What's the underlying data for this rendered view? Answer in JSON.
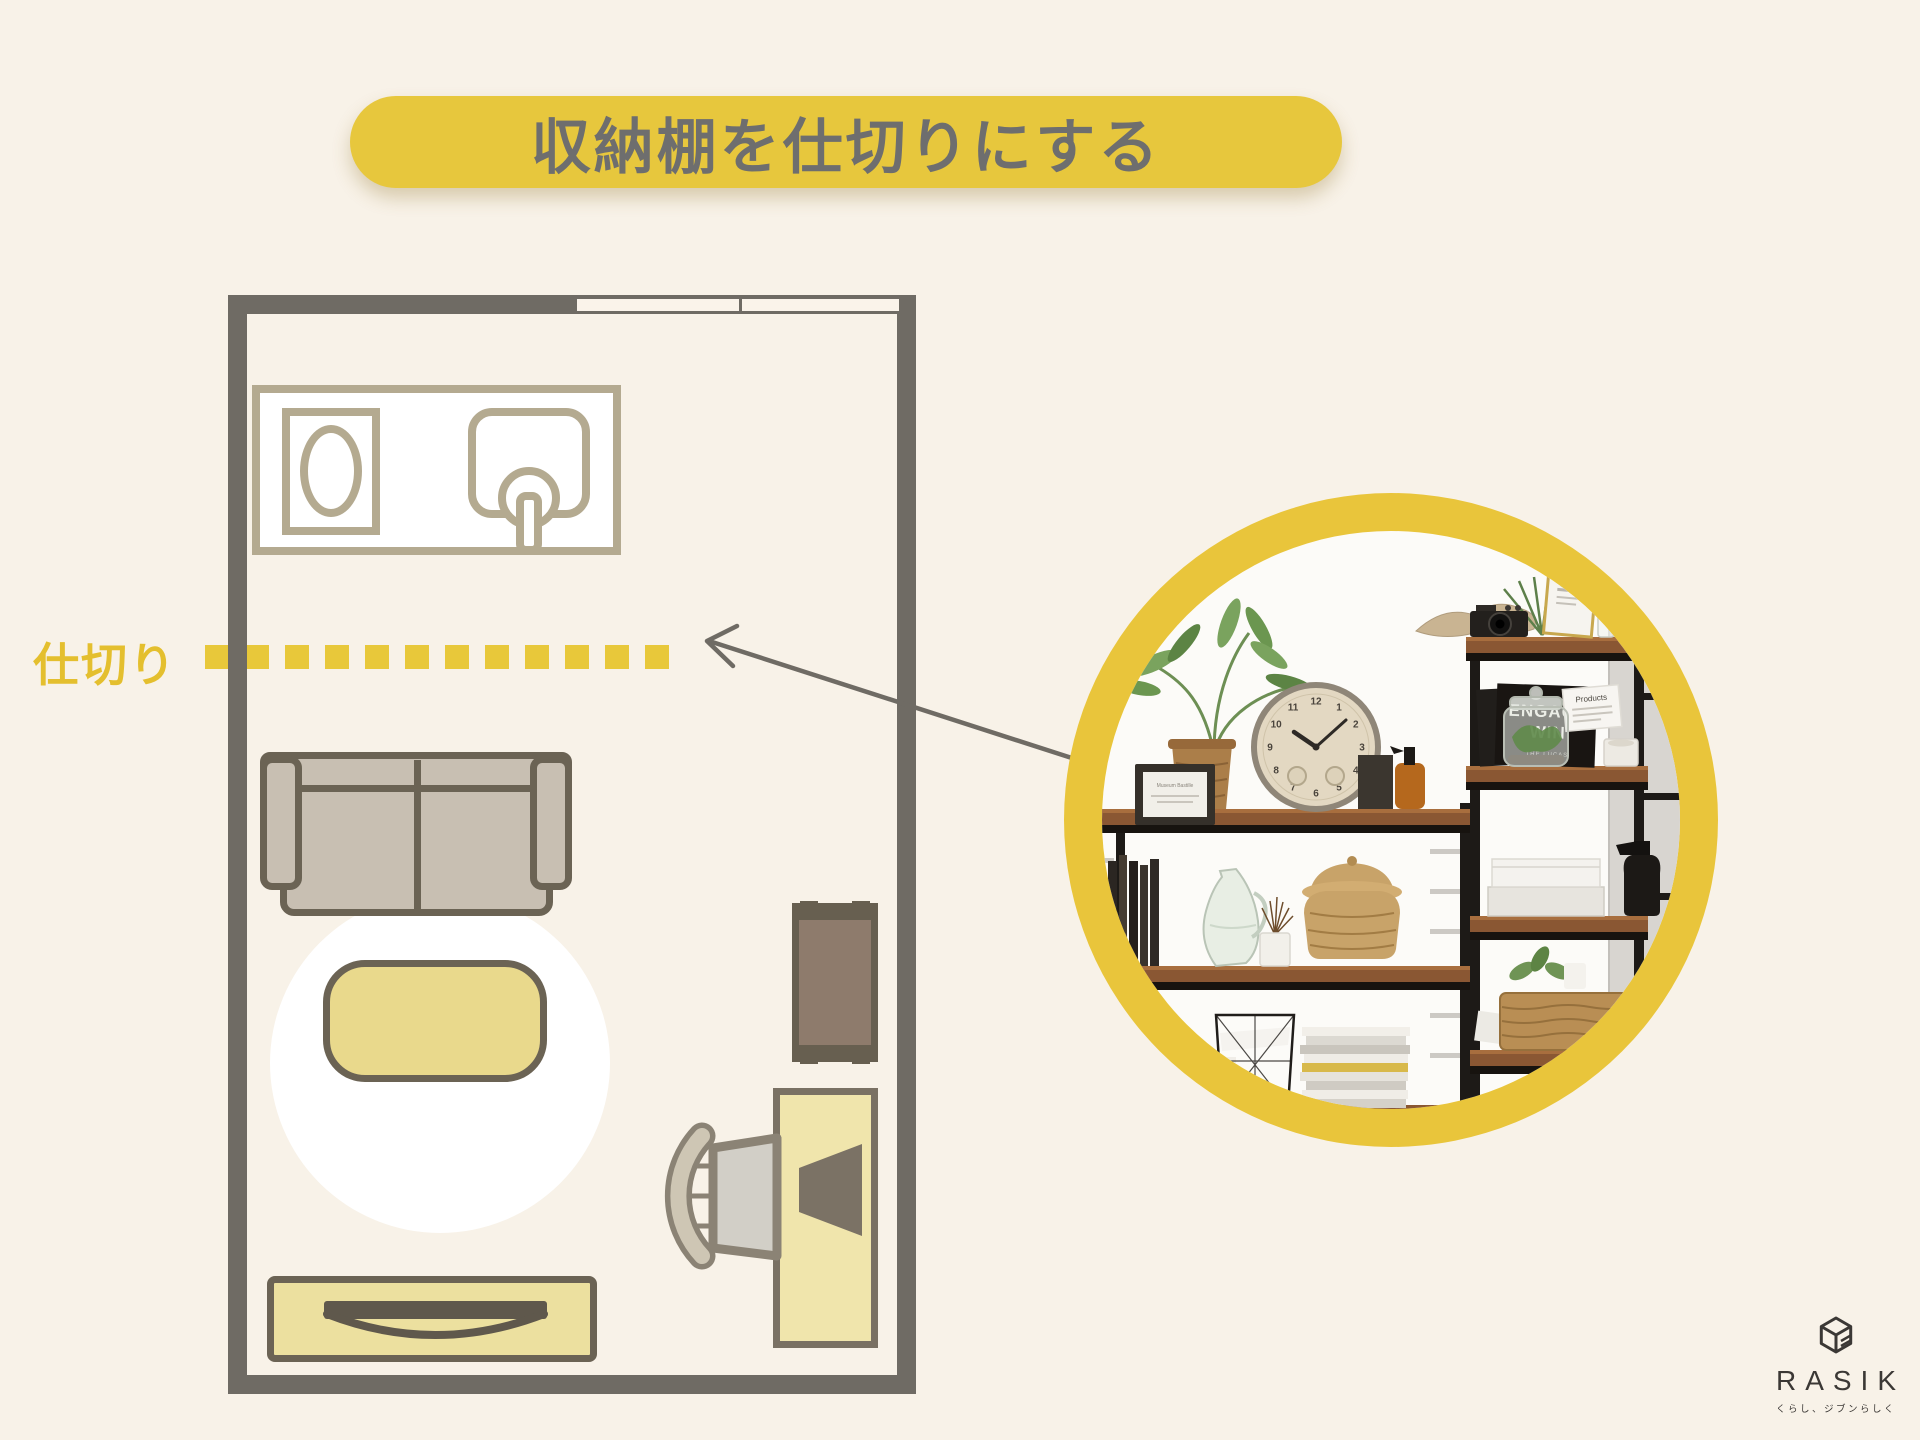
{
  "title": "収納棚を仕切りにする",
  "floorplan": {
    "divider_label": "仕切り"
  },
  "photo": {
    "clock_numbers": [
      "12",
      "1",
      "2",
      "3",
      "4",
      "5",
      "6",
      "7",
      "8",
      "9",
      "10",
      "11"
    ],
    "clock_time": "10:08",
    "sign_line1": "ENGAGE",
    "sign_line2": "WIN",
    "sign_line3": "THE LUCAS",
    "card_text": "Products",
    "frame_caption": "Museum Bastille"
  },
  "logo": {
    "brand": "RASIK",
    "tagline": "くらし、ジブンらしく"
  },
  "colors": {
    "background": "#f8f2e8",
    "accent_yellow": "#e7c73d",
    "title_text": "#6e6e6e",
    "wall_gray": "#6f6b64",
    "divider_yellow": "#e8c83a",
    "furniture_outline": "#6b6354",
    "kitchen_outline": "#b4aa90",
    "ring_yellow": "#e9c53b",
    "logo_ink": "#3b3835"
  }
}
